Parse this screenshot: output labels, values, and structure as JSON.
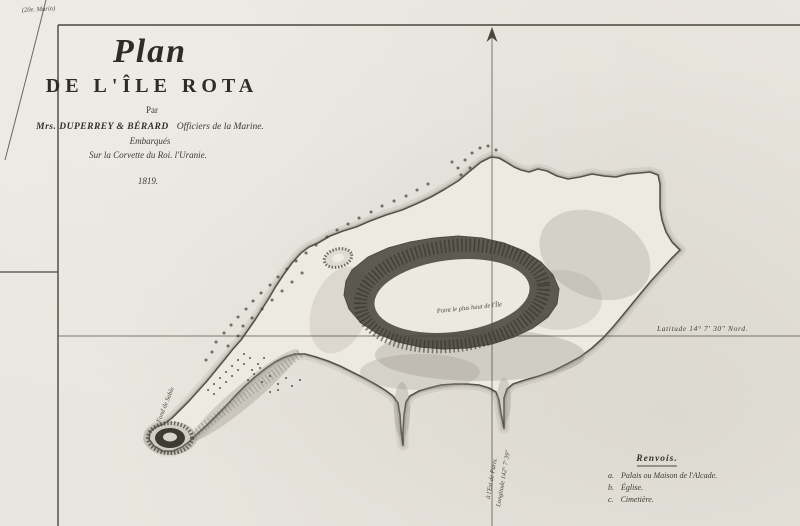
{
  "corner_note": "(20e. Marin)",
  "title_block": {
    "script_title": "Plan",
    "main_title": "DE L'ÎLE ROTA",
    "par": "Par",
    "authors": "Mrs. DUPERREY & BÉRARD",
    "authors_role": "Officiers de la Marine.",
    "line_embarked": "Embarqués",
    "line_ship": "Sur la Corvette du Roi. l'Uranie.",
    "year": "1819."
  },
  "graticule": {
    "latitude_label": "Latitude 14° 7' 30\" Nord.",
    "longitude_label": "Longitude 142° 7' 39\"",
    "longitude_sublabel": "à l'Est de Paris."
  },
  "map_labels": {
    "highest_point": "Point le plus haut de l'Île",
    "seabed_note": "Fond de Sable"
  },
  "legend": {
    "heading": "Renvois.",
    "items": [
      {
        "key": "a.",
        "label": "Palais ou Maison de l'Alcade."
      },
      {
        "key": "b.",
        "label": "Église."
      },
      {
        "key": "c.",
        "label": "Cimetière."
      }
    ]
  },
  "colors": {
    "paper": "#e9e6df",
    "ink": "#4a473f",
    "hachure": "#3f3d37"
  }
}
